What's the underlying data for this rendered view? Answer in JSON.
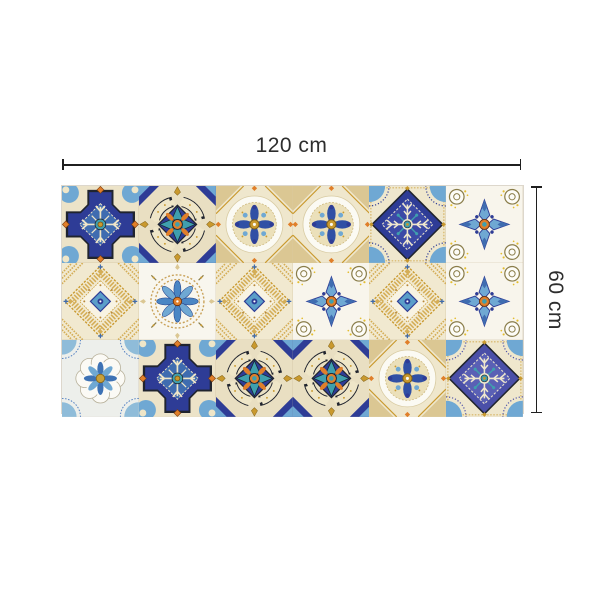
{
  "dimensions": {
    "width_label": "120 cm",
    "height_label": "60 cm",
    "line_color": "#1f1f1f",
    "text_color": "#2d2d2d"
  },
  "rug": {
    "rows": 3,
    "cols": 6,
    "tile_style": "moroccan-azulejo-patchwork",
    "grid": [
      [
        "stepped-diamond",
        "flower-scroll-teal",
        "medallion-circle",
        "medallion-circle",
        "ornate-diamond-navy",
        "flower-cross-white"
      ],
      [
        "lace-diamond",
        "lace-circle-flower",
        "lace-diamond",
        "flower-cross-white",
        "lace-diamond",
        "flower-cross-white"
      ],
      [
        "rosette",
        "stepped-diamond",
        "flower-scroll-teal",
        "flower-scroll-teal",
        "medallion-circle",
        "ornate-diamond-violet"
      ]
    ],
    "palette": {
      "navy": "#2e3c96",
      "blue": "#3f6cb0",
      "blue_deep": "#3050a5",
      "light_blue": "#6fa8d3",
      "sky": "#8fbcd9",
      "teal": "#3f9fae",
      "cream": "#efe6c8",
      "cream_bg": "#ece3c8",
      "tan": "#dbc793",
      "gold": "#c9992e",
      "orange": "#e07f2a",
      "white": "#fbfaf3",
      "outline": "#20242e",
      "violet": "#4a4fa8",
      "olive": "#8a7d4a",
      "yellow": "#e3bd30"
    }
  }
}
